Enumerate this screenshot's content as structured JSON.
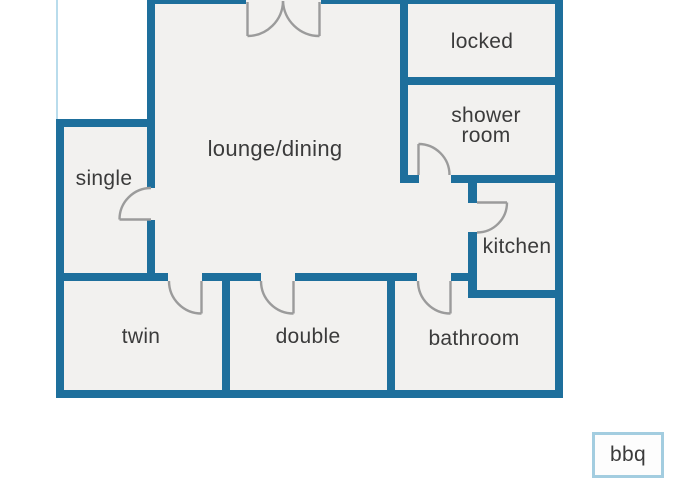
{
  "palette": {
    "background": "#ffffff",
    "wall": "#1e6f9c",
    "room_fill": "#f2f1ef",
    "door_swing": "#9b9b9b",
    "text": "#3b3b3b",
    "terrace_outline": "#b9dcec",
    "bbq_outline": "#a3cde0"
  },
  "floorplan": {
    "rooms": [
      {
        "name": "lounge-dining",
        "label": "lounge/dining"
      },
      {
        "name": "single",
        "label": "single"
      },
      {
        "name": "locked",
        "label": "locked"
      },
      {
        "name": "shower-room",
        "label": "shower room"
      },
      {
        "name": "kitchen",
        "label": "kitchen"
      },
      {
        "name": "twin",
        "label": "twin"
      },
      {
        "name": "double",
        "label": "double"
      },
      {
        "name": "bathroom",
        "label": "bathroom"
      }
    ],
    "outdoor": {
      "bbq_label": "bbq"
    }
  }
}
